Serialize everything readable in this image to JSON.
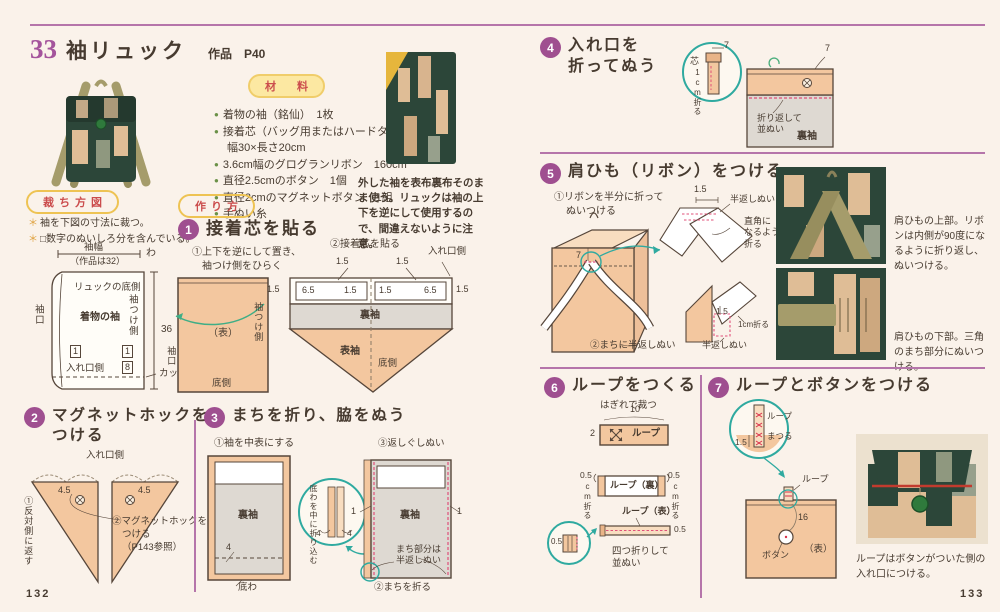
{
  "page": {
    "left_number": "132",
    "right_number": "133"
  },
  "header": {
    "number": "33",
    "title": "袖リュック",
    "subtitle": "作品　P40"
  },
  "materials": {
    "heading": "材　料",
    "item0": "着物の袖（銘仙）　1枚",
    "item1": "接着芯（バッグ用またはハードタイプ）",
    "item1b": "幅30×長さ20cm",
    "item2": "3.6cm幅のグログランリボン　160cm",
    "item3": "直径2.5cmのボタン　1個",
    "item4": "直径2cmのマグネットボタン　1組",
    "item5": "手ぬい糸"
  },
  "sleeve_photo": {
    "caption": "外した袖を表布裏布そのまま使う。リュックは袖の上下を逆にして使用するので、間違えないように注意。"
  },
  "cutting": {
    "heading": "裁ち方図",
    "note1": "袖を下図の寸法に裁つ。",
    "note2": "□数字のぬいしろ分を含んでいる。",
    "dim_width": "袖幅",
    "dim_width_note": "（作品は32）",
    "fold": "わ",
    "sleeve_opening": "袖口",
    "bottom_side": "リュックの底側",
    "kimono_sleeve": "着物の袖",
    "attach_side": "袖つけ側",
    "dim_height": "36",
    "seam1": "1",
    "opening_side": "入れ口側",
    "seam8": "8",
    "cut_label": "カットする"
  },
  "howto": {
    "heading": "作り方"
  },
  "step1": {
    "num": "1",
    "title": "接着芯を貼る",
    "ann1a": "①上下を逆にして置き、",
    "ann1b": "袖つけ側をひらく",
    "front": "（表）",
    "attach_side": "袖つけ側",
    "sleeve_opening": "袖口",
    "bottom": "底側",
    "ann2": "②接着芯を貼る",
    "opening_side": "入れ口側",
    "n15": "1.5",
    "n65": "6.5",
    "back_sleeve": "裏袖",
    "front_sleeve": "表袖",
    "bottom_side": "底側"
  },
  "step2": {
    "num": "2",
    "title1": "マグネットホックを",
    "title2": "つける",
    "opening_side": "入れ口側",
    "n45": "4.5",
    "ann1": "①反対側に返す",
    "ann2a": "②マグネットホックを",
    "ann2b": "つける",
    "ann2c": "（P143参照）"
  },
  "step3": {
    "num": "3",
    "title": "まちを折り、脇をぬう",
    "ann1": "①袖を中表にする",
    "back_sleeve": "裏袖",
    "n4": "4",
    "bottom_fold": "底わ",
    "inset_note": "底わを中に折り込む",
    "ann3": "③返しぐしぬい",
    "n1": "1",
    "gusset_note1": "まち部分は",
    "gusset_note2": "半返しぬい",
    "ann2": "②まちを折る"
  },
  "step4": {
    "num": "4",
    "title1": "入れ口を",
    "title2": "折ってぬう",
    "core": "芯",
    "n7": "7",
    "fold_1cm": "1cm折る",
    "fold_note1": "折り返して",
    "fold_note2": "並ぬい",
    "back_sleeve": "裏袖"
  },
  "step5": {
    "num": "5",
    "title": "肩ひも（リボン）をつける",
    "ann1a": "①リボンを半分に折って",
    "ann1b": "ぬいつける",
    "n7": "7",
    "n15": "1.5",
    "half_backstitch": "半返しぬい",
    "right_angle1": "直角に",
    "right_angle2": "なるように",
    "right_angle3": "折る",
    "fold_1cm": "1cm折る",
    "ann2": "②まちに半返しぬい",
    "caption_top": "肩ひもの上部。リボンは内側が90度になるように折り返し、ぬいつける。",
    "caption_bottom": "肩ひもの下部。三角のまち部分にぬいつける。"
  },
  "step6": {
    "num": "6",
    "title": "ループをつくる",
    "cut_note": "はぎれで裁つ",
    "n10": "10",
    "n2": "2",
    "loop": "ループ",
    "n05": "0.5",
    "cm_fold": "cm折る",
    "loop_back": "ループ（裏）",
    "loop_front": "ループ（表）",
    "quarter1": "四つ折りして",
    "quarter2": "並ぬい"
  },
  "step7": {
    "num": "7",
    "title": "ループとボタンをつける",
    "loop": "ループ",
    "matsuru": "まつる",
    "n15": "1.5",
    "n16": "16",
    "button": "ボタン",
    "front": "（表）",
    "caption": "ループはボタンがついた側の入れ口につける。"
  }
}
